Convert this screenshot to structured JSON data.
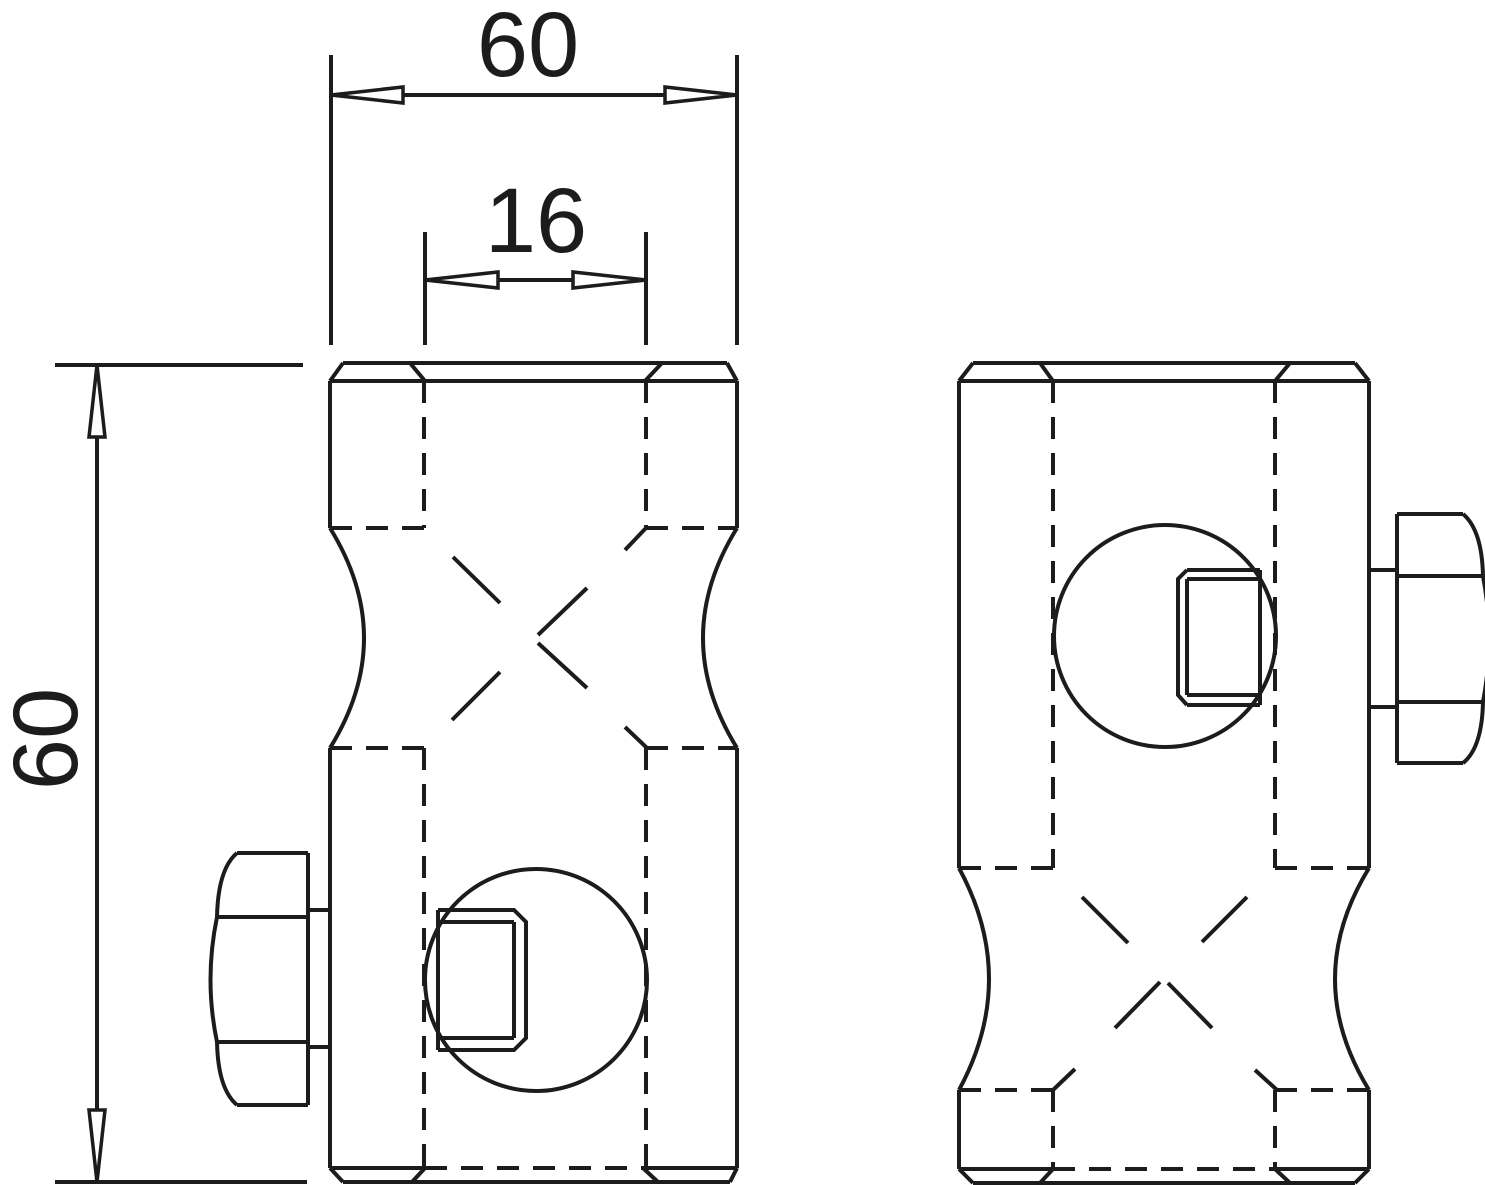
{
  "drawing": {
    "background_color": "#ffffff",
    "line_color": "#1c1c1c",
    "dimensions": {
      "top_width": {
        "value": "60"
      },
      "inner_width": {
        "value": "16"
      },
      "left_height": {
        "value": "60"
      }
    }
  }
}
